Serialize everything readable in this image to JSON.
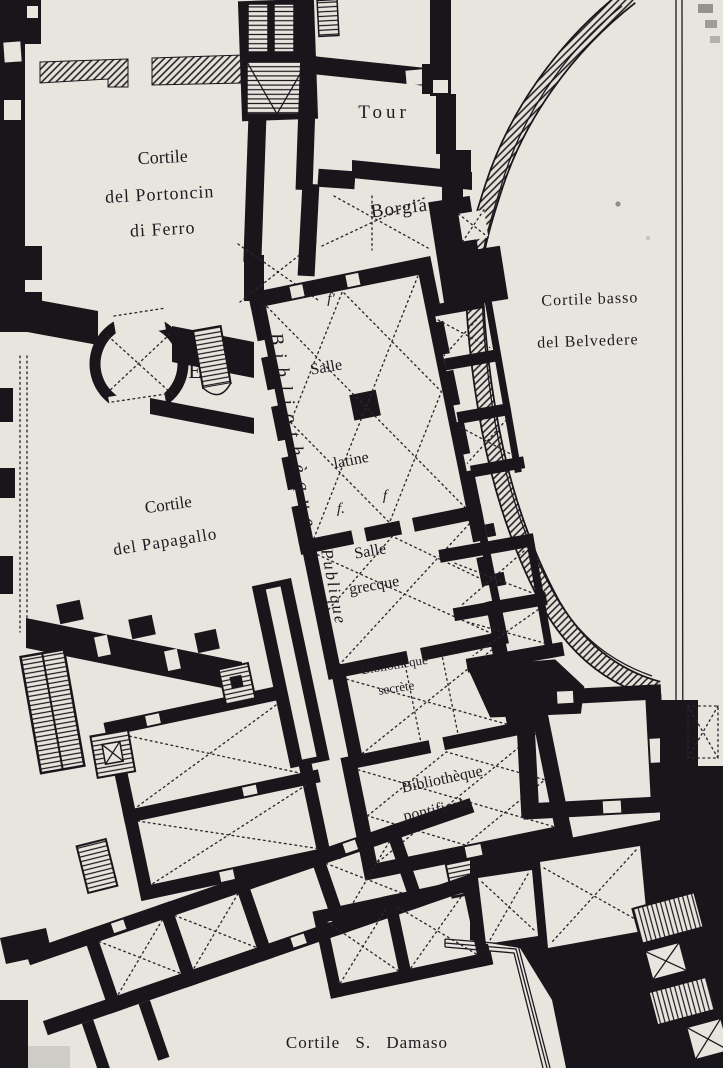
{
  "plan": {
    "paper_color": "#e8e5de",
    "ink_color": "#18161b",
    "labels": [
      {
        "id": "label-cortile-portoncin-1",
        "text": "Cortile",
        "x": 163,
        "y": 163,
        "size": 18,
        "rotate": -3
      },
      {
        "id": "label-cortile-portoncin-2",
        "text": "del Portoncin",
        "x": 160,
        "y": 200,
        "size": 18,
        "rotate": -3,
        "spacing": 1
      },
      {
        "id": "label-cortile-portoncin-3",
        "text": "di Ferro",
        "x": 163,
        "y": 235,
        "size": 18,
        "rotate": -3,
        "spacing": 1
      },
      {
        "id": "label-tour",
        "text": "Tour",
        "x": 384,
        "y": 118,
        "size": 19,
        "spacing": 4
      },
      {
        "id": "label-borgia",
        "text": "Borgia",
        "x": 400,
        "y": 214,
        "size": 19,
        "rotate": -7,
        "spacing": 1
      },
      {
        "id": "label-cortile-basso-1",
        "text": "Cortile basso",
        "x": 590,
        "y": 304,
        "size": 16,
        "rotate": -2,
        "spacing": 1
      },
      {
        "id": "label-cortile-basso-2",
        "text": "del Belvedere",
        "x": 588,
        "y": 346,
        "size": 16,
        "rotate": -2,
        "spacing": 1
      },
      {
        "id": "label-bibliotheque",
        "text": "Bibliothèque",
        "x": 270,
        "y": 334,
        "size": 19,
        "rotate": 80,
        "anchor": "start",
        "class": "lbl italic",
        "spacing": 9
      },
      {
        "id": "label-salle-latine-1",
        "text": "Salle",
        "x": 327,
        "y": 372,
        "size": 16,
        "rotate": -10
      },
      {
        "id": "label-salle-latine-2",
        "text": "latine",
        "x": 352,
        "y": 465,
        "size": 16,
        "rotate": -11
      },
      {
        "id": "label-publique",
        "text": "Publique",
        "x": 321,
        "y": 550,
        "size": 17,
        "rotate": 79,
        "anchor": "start",
        "class": "lbl italic",
        "spacing": 2
      },
      {
        "id": "label-salle-grecque-1",
        "text": "Salle",
        "x": 371,
        "y": 556,
        "size": 16,
        "rotate": -10
      },
      {
        "id": "label-salle-grecque-2",
        "text": "grecque",
        "x": 375,
        "y": 590,
        "size": 16,
        "rotate": -10
      },
      {
        "id": "label-bibliotheque-secrete-1",
        "text": "Bibliothèque",
        "x": 395,
        "y": 669,
        "size": 13,
        "rotate": -9
      },
      {
        "id": "label-bibliotheque-secrete-2",
        "text": "secrète",
        "x": 397,
        "y": 692,
        "size": 13,
        "rotate": -9
      },
      {
        "id": "label-bibliotheque-pontificale-1",
        "text": "Bibliothèque",
        "x": 443,
        "y": 784,
        "size": 16,
        "rotate": -12
      },
      {
        "id": "label-bibliotheque-pontificale-2",
        "text": "pontificale",
        "x": 438,
        "y": 814,
        "size": 16,
        "rotate": -12
      },
      {
        "id": "label-cortile-papagallo-1",
        "text": "Cortile",
        "x": 169,
        "y": 510,
        "size": 17,
        "rotate": -8
      },
      {
        "id": "label-cortile-papagallo-2",
        "text": "del Papagallo",
        "x": 166,
        "y": 547,
        "size": 17,
        "rotate": -9,
        "spacing": 1
      },
      {
        "id": "label-cortile-damaso",
        "text": "Cortile S. Damaso",
        "x": 367,
        "y": 1048,
        "size": 17,
        "spacing": 1,
        "word_spacing": 10
      },
      {
        "id": "label-stair-e",
        "text": "E",
        "x": 195,
        "y": 378,
        "size": 22
      },
      {
        "id": "label-f-top-left",
        "text": "f",
        "x": 263,
        "y": 316,
        "size": 15,
        "class": "lbl italic"
      },
      {
        "id": "label-f-top-right",
        "text": "f'",
        "x": 331,
        "y": 303,
        "size": 15,
        "class": "lbl italic"
      },
      {
        "id": "label-f-mid-left",
        "text": "f.",
        "x": 341,
        "y": 513,
        "size": 15,
        "class": "lbl italic"
      },
      {
        "id": "label-f-mid-right",
        "text": "f",
        "x": 385,
        "y": 500,
        "size": 15,
        "class": "lbl italic"
      }
    ]
  }
}
